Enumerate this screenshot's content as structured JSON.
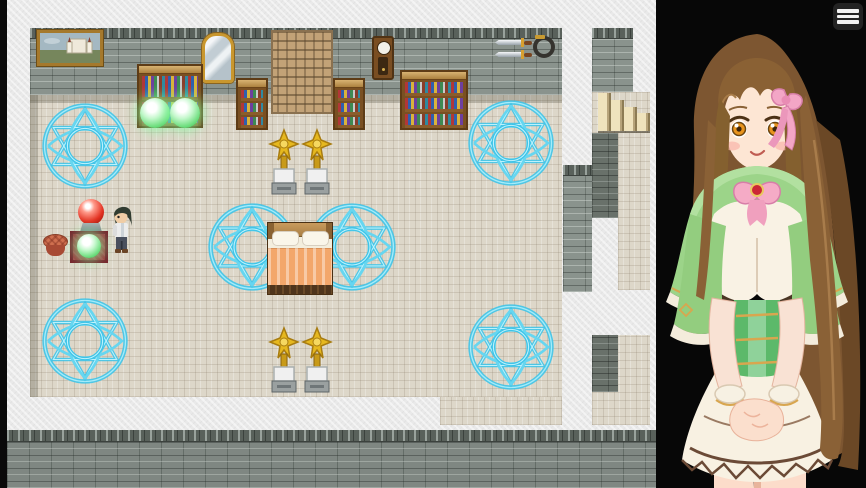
{
  "window": {
    "type": "rpg-game",
    "canvas_size": "866x488"
  },
  "menu_button": {
    "label": "Menu",
    "icon": "hamburger-menu-icon",
    "bar_count": 3
  },
  "map": {
    "label": "Stone room with magic circles, bed and bookshelves",
    "wall_objects": [
      "landscape-painting",
      "wall-mirror",
      "inscribed-tablet",
      "grandfather-clock",
      "mounted-swords",
      "coiled-whip"
    ],
    "furniture": [
      "bookshelf-with-green-orbs",
      "bookshelf",
      "bookshelf",
      "wide-bookshelf",
      "double-bed",
      "star-trophy",
      "star-trophy",
      "star-trophy",
      "star-trophy",
      "red-crystal-ball",
      "green-glow-orb-on-red-mat",
      "round-stool",
      "stone-stairs"
    ],
    "magic_circle_count": 6,
    "player": "player-character-sprite",
    "colors": {
      "floor": "#ddd7c9",
      "wall": "#8a938d",
      "magic_circle": "#41c6ea",
      "background_paper": "#e9e9e9",
      "letterbox": "#0a0a0a"
    }
  },
  "portrait": {
    "label": "Heroine portrait",
    "background": "#070707",
    "features": {
      "hair": "long brown hair",
      "eyes": "amber",
      "accessory": "pink hair ribbon",
      "outfit": "green capelet with gold trim, pink bow with red gem, white dress, layered white skirt"
    }
  }
}
